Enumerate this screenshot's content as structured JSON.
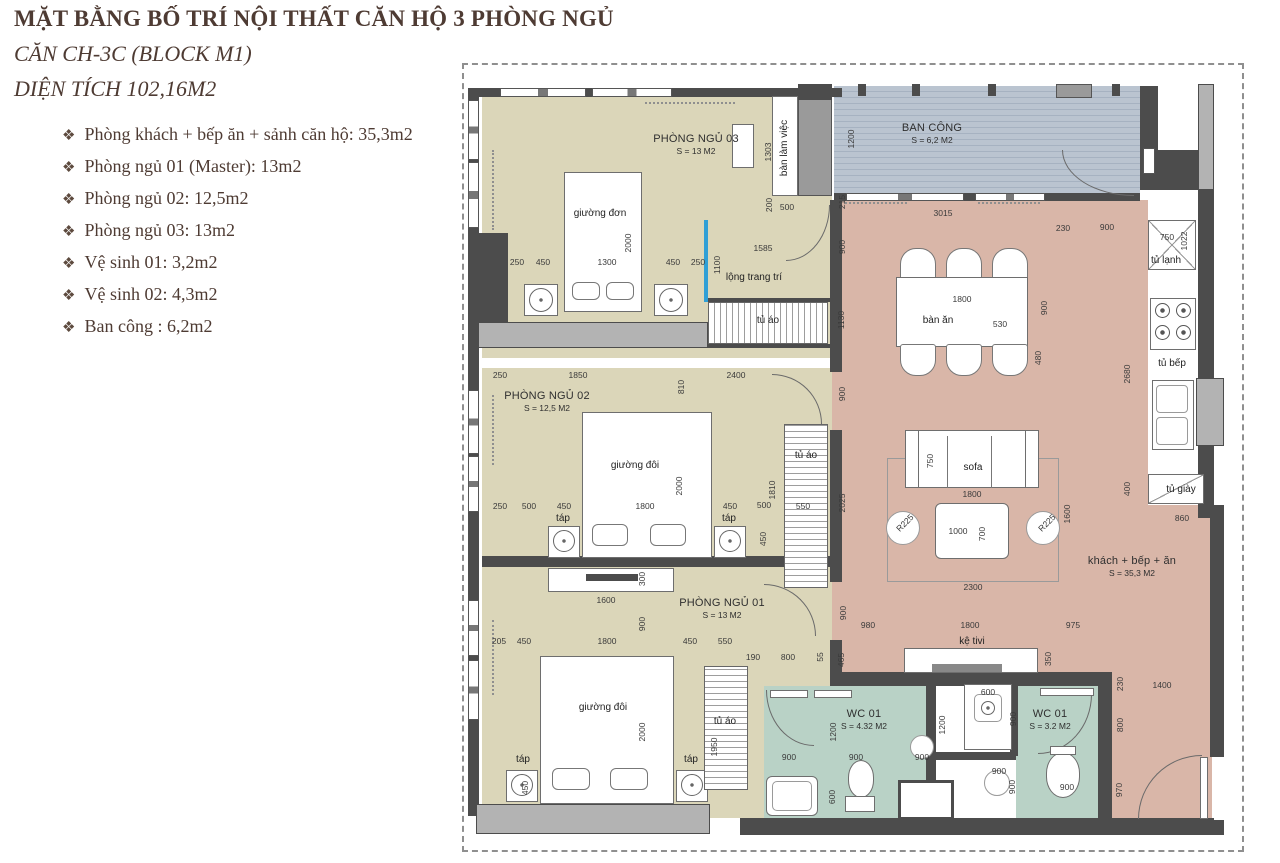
{
  "header": {
    "title": "MẶT BẰNG BỐ TRÍ NỘI THẤT CĂN HỘ 3 PHÒNG NGỦ",
    "subtitle1": "CĂN CH-3C (BLOCK M1)",
    "subtitle2": "DIỆN TÍCH 102,16M2",
    "bullet": "❖"
  },
  "room_list": [
    {
      "text": "Phòng khách + bếp ăn + sảnh căn hộ: 35,3m2"
    },
    {
      "text": "Phòng ngủ 01 (Master): 13m2"
    },
    {
      "text": "Phòng ngủ 02: 12,5m2"
    },
    {
      "text": "Phòng ngủ 03: 13m2"
    },
    {
      "text": "Vệ sinh 01: 3,2m2"
    },
    {
      "text": "Vệ sinh 02: 4,3m2"
    },
    {
      "text": "Ban công : 6,2m2"
    }
  ],
  "plan": {
    "rooms": [
      {
        "name": "PHÒNG NGỦ 03",
        "area": "S = 13 M2"
      },
      {
        "name": "BAN CÔNG",
        "area": "S = 6,2 M2"
      },
      {
        "name": "PHÒNG NGỦ 02",
        "area": "S = 12,5 M2"
      },
      {
        "name": "PHÒNG NGỦ 01",
        "area": "S = 13 M2"
      },
      {
        "name": "WC 01",
        "area": "S = 4.32 M2"
      },
      {
        "name": "WC 01",
        "area": "S = 3.2 M2"
      },
      {
        "name": "khách + bếp + ăn",
        "area": "S = 35,3 M2"
      }
    ],
    "labels": [
      {
        "t": "giường đơn",
        "x": 600,
        "y": 214
      },
      {
        "t": "bàn làm việc",
        "x": 785,
        "y": 148,
        "r": 90
      },
      {
        "t": "lộng trang trí",
        "x": 754,
        "y": 278
      },
      {
        "t": "tủ áo",
        "x": 768,
        "y": 321
      },
      {
        "t": "tủ áo",
        "x": 806,
        "y": 456
      },
      {
        "t": "tủ áo",
        "x": 725,
        "y": 722
      },
      {
        "t": "táp",
        "x": 563,
        "y": 519
      },
      {
        "t": "táp",
        "x": 729,
        "y": 519
      },
      {
        "t": "táp",
        "x": 523,
        "y": 760
      },
      {
        "t": "táp",
        "x": 691,
        "y": 760
      },
      {
        "t": "giường đôi",
        "x": 635,
        "y": 466
      },
      {
        "t": "giường đôi",
        "x": 603,
        "y": 708
      },
      {
        "t": "bàn ăn",
        "x": 938,
        "y": 321
      },
      {
        "t": "tủ lạnh",
        "x": 1166,
        "y": 261
      },
      {
        "t": "tủ bếp",
        "x": 1172,
        "y": 364
      },
      {
        "t": "sofa",
        "x": 973,
        "y": 468
      },
      {
        "t": "kệ tivi",
        "x": 972,
        "y": 642
      },
      {
        "t": "tủ giày",
        "x": 1181,
        "y": 490
      }
    ],
    "dims": [
      {
        "t": "1303",
        "x": 768,
        "y": 152,
        "r": 90
      },
      {
        "t": "1200",
        "x": 851,
        "y": 139,
        "r": 90
      },
      {
        "t": "200",
        "x": 769,
        "y": 205,
        "r": 90
      },
      {
        "t": "500",
        "x": 787,
        "y": 207
      },
      {
        "t": "215",
        "x": 842,
        "y": 202,
        "r": 90
      },
      {
        "t": "250",
        "x": 517,
        "y": 262
      },
      {
        "t": "450",
        "x": 543,
        "y": 262
      },
      {
        "t": "1300",
        "x": 607,
        "y": 262
      },
      {
        "t": "450",
        "x": 673,
        "y": 262
      },
      {
        "t": "250",
        "x": 698,
        "y": 262
      },
      {
        "t": "1100",
        "x": 717,
        "y": 265,
        "r": 90
      },
      {
        "t": "2000",
        "x": 628,
        "y": 243,
        "r": 90
      },
      {
        "t": "1585",
        "x": 763,
        "y": 248
      },
      {
        "t": "900",
        "x": 842,
        "y": 247,
        "r": 90
      },
      {
        "t": "1130",
        "x": 841,
        "y": 320,
        "r": 90
      },
      {
        "t": "3015",
        "x": 943,
        "y": 213
      },
      {
        "t": "230",
        "x": 1063,
        "y": 228
      },
      {
        "t": "900",
        "x": 1107,
        "y": 227
      },
      {
        "t": "750",
        "x": 1167,
        "y": 237
      },
      {
        "t": "1022",
        "x": 1184,
        "y": 241,
        "r": 90
      },
      {
        "t": "1800",
        "x": 962,
        "y": 299
      },
      {
        "t": "530",
        "x": 1000,
        "y": 324
      },
      {
        "t": "900",
        "x": 1044,
        "y": 308,
        "r": 90
      },
      {
        "t": "480",
        "x": 1038,
        "y": 358,
        "r": 90
      },
      {
        "t": "2680",
        "x": 1127,
        "y": 374,
        "r": 90
      },
      {
        "t": "250",
        "x": 500,
        "y": 375
      },
      {
        "t": "1850",
        "x": 578,
        "y": 375
      },
      {
        "t": "2400",
        "x": 736,
        "y": 375
      },
      {
        "t": "810",
        "x": 681,
        "y": 387,
        "r": 90
      },
      {
        "t": "900",
        "x": 842,
        "y": 394,
        "r": 90
      },
      {
        "t": "2000",
        "x": 679,
        "y": 486,
        "r": 90
      },
      {
        "t": "250",
        "x": 500,
        "y": 506
      },
      {
        "t": "500",
        "x": 529,
        "y": 506
      },
      {
        "t": "450",
        "x": 564,
        "y": 506
      },
      {
        "t": "1800",
        "x": 645,
        "y": 506
      },
      {
        "t": "450",
        "x": 730,
        "y": 506
      },
      {
        "t": "500",
        "x": 764,
        "y": 505
      },
      {
        "t": "550",
        "x": 803,
        "y": 506
      },
      {
        "t": "1810",
        "x": 772,
        "y": 490,
        "r": 90
      },
      {
        "t": "2025",
        "x": 842,
        "y": 503,
        "r": 90
      },
      {
        "t": "450",
        "x": 763,
        "y": 539,
        "r": 90
      },
      {
        "t": "750",
        "x": 930,
        "y": 461,
        "r": 90
      },
      {
        "t": "1800",
        "x": 972,
        "y": 494
      },
      {
        "t": "1600",
        "x": 1067,
        "y": 514,
        "r": 90
      },
      {
        "t": "1000",
        "x": 958,
        "y": 531
      },
      {
        "t": "700",
        "x": 982,
        "y": 534,
        "r": 90
      },
      {
        "t": "R225",
        "x": 905,
        "y": 523,
        "r": 45
      },
      {
        "t": "R225",
        "x": 1047,
        "y": 523,
        "r": 45
      },
      {
        "t": "2300",
        "x": 973,
        "y": 587
      },
      {
        "t": "400",
        "x": 1127,
        "y": 489,
        "r": 90
      },
      {
        "t": "860",
        "x": 1182,
        "y": 518
      },
      {
        "t": "300",
        "x": 642,
        "y": 579,
        "r": 90
      },
      {
        "t": "1600",
        "x": 606,
        "y": 600
      },
      {
        "t": "900",
        "x": 642,
        "y": 624,
        "r": 90
      },
      {
        "t": "205",
        "x": 499,
        "y": 641
      },
      {
        "t": "450",
        "x": 524,
        "y": 641
      },
      {
        "t": "1800",
        "x": 607,
        "y": 641
      },
      {
        "t": "450",
        "x": 690,
        "y": 641
      },
      {
        "t": "550",
        "x": 725,
        "y": 641
      },
      {
        "t": "190",
        "x": 753,
        "y": 657
      },
      {
        "t": "800",
        "x": 788,
        "y": 657
      },
      {
        "t": "55",
        "x": 820,
        "y": 657,
        "r": 90
      },
      {
        "t": "465",
        "x": 841,
        "y": 660,
        "r": 90
      },
      {
        "t": "900",
        "x": 843,
        "y": 613,
        "r": 90
      },
      {
        "t": "980",
        "x": 868,
        "y": 625
      },
      {
        "t": "1800",
        "x": 970,
        "y": 625
      },
      {
        "t": "975",
        "x": 1073,
        "y": 625
      },
      {
        "t": "350",
        "x": 1048,
        "y": 659,
        "r": 90
      },
      {
        "t": "230",
        "x": 1120,
        "y": 684,
        "r": 90
      },
      {
        "t": "1400",
        "x": 1162,
        "y": 685
      },
      {
        "t": "2000",
        "x": 642,
        "y": 732,
        "r": 90
      },
      {
        "t": "1950",
        "x": 714,
        "y": 747,
        "r": 90
      },
      {
        "t": "1200",
        "x": 833,
        "y": 732,
        "r": 90
      },
      {
        "t": "600",
        "x": 832,
        "y": 797,
        "r": 90
      },
      {
        "t": "450",
        "x": 525,
        "y": 788,
        "r": 90
      },
      {
        "t": "600",
        "x": 988,
        "y": 692
      },
      {
        "t": "900",
        "x": 1013,
        "y": 719,
        "r": 90
      },
      {
        "t": "1200",
        "x": 942,
        "y": 725,
        "r": 90
      },
      {
        "t": "900",
        "x": 789,
        "y": 757
      },
      {
        "t": "900",
        "x": 856,
        "y": 757
      },
      {
        "t": "900",
        "x": 922,
        "y": 757
      },
      {
        "t": "900",
        "x": 999,
        "y": 771
      },
      {
        "t": "900",
        "x": 1012,
        "y": 787,
        "r": 90
      },
      {
        "t": "900",
        "x": 1067,
        "y": 787
      },
      {
        "t": "970",
        "x": 1119,
        "y": 790,
        "r": 90
      },
      {
        "t": "800",
        "x": 1120,
        "y": 725,
        "r": 90
      }
    ]
  },
  "colors": {
    "bedroom_floor": "#dbd6b9",
    "living_floor": "#d9b6a8",
    "wc_floor": "#b9d2c6",
    "balcony_floor": "#b7c1cd",
    "wall": "#4c4c4c",
    "accent_blue": "#2f9fd6",
    "heading_text": "#4e3b33"
  }
}
